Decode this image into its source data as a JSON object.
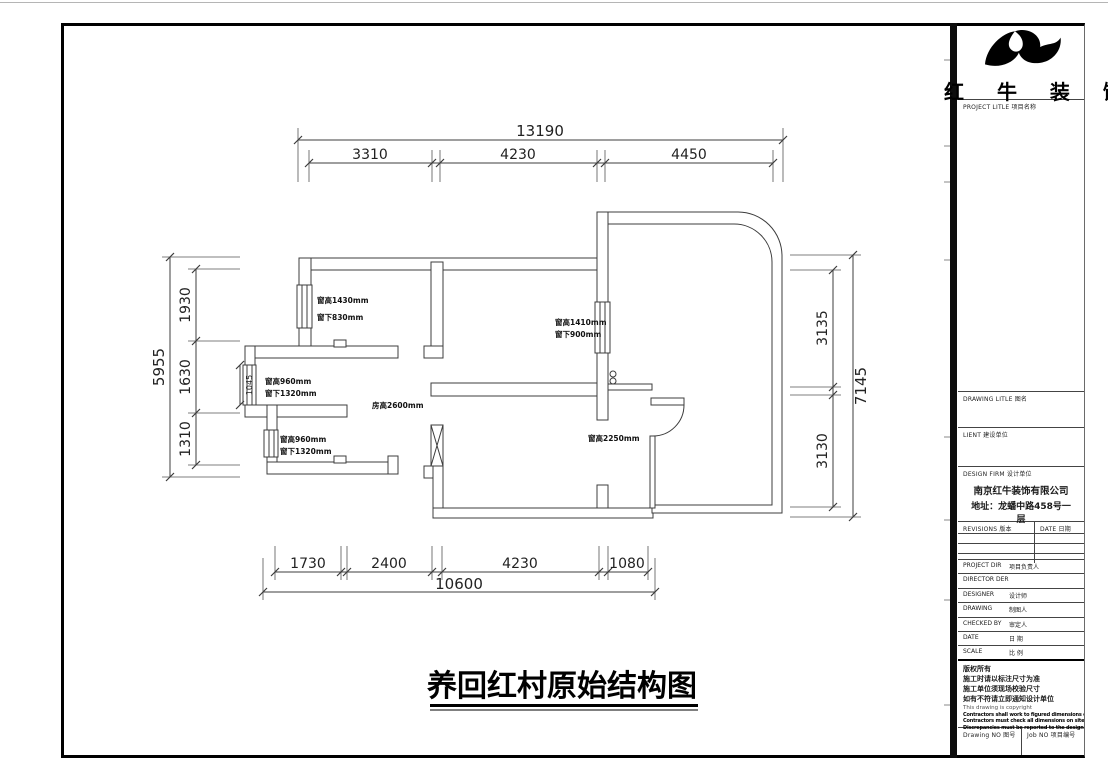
{
  "colors": {
    "line": "#3c3c3c",
    "wall": "#2f2f2f",
    "text": "#1a1a1a",
    "frame": "#000000"
  },
  "logo": {
    "company_name": "红 牛 装 饰"
  },
  "title_block": {
    "project_title_label": "PROJECT LITLE  项目名称",
    "drawing_title_label": "DRAWING LITLE  图名",
    "client_label": "LIENT  建设单位",
    "design_firm_label": "DESIGN FIRM  设计单位",
    "firm_name": "南京红牛装饰有限公司",
    "firm_address_line1": "地址：龙蟠中路458号一",
    "firm_address_line2": "层",
    "revisions_label": "REVISIONS  版本",
    "date_col_label": "DATE  日期",
    "rows": [
      {
        "en": "PROJECT DIR",
        "zh": "项目负责人"
      },
      {
        "en": "DIRECTOR DER",
        "zh": ""
      },
      {
        "en": "DESIGNER",
        "zh": "设计师"
      },
      {
        "en": "DRAWING",
        "zh": "制图人"
      },
      {
        "en": "CHECKED BY",
        "zh": "审定人"
      },
      {
        "en": "DATE",
        "zh": "日 期"
      },
      {
        "en": "SCALE",
        "zh": "比 例"
      }
    ],
    "copyright": {
      "line1": "版权所有",
      "line2": "施工时请以标注尺寸为准",
      "line3": "施工单位须现场校验尺寸",
      "line4": "如有不符请立即通知设计单位",
      "line5": "This drawing is copyright",
      "line6": "Contractors shall work to figured dimensions only",
      "line7": "Contractors must check all dimensions on site",
      "line8": "Discrepancies must be reported to the designer"
    },
    "drawing_no_label": "Drawing NO  图号",
    "job_no_label": "Job NO  项目编号"
  },
  "drawing": {
    "title": "养回红村原始结构图",
    "dims": {
      "top": {
        "overall": "13190",
        "s1": "3310",
        "s2": "4230",
        "s3": "4450"
      },
      "left": {
        "overall": "5955",
        "s1": "1930",
        "s2": "1630",
        "s3": "1310"
      },
      "right": {
        "overall": "7145",
        "s1": "3135",
        "s2": "3130"
      },
      "bottom": {
        "overall": "10600",
        "s1": "1730",
        "s2": "2400",
        "s3": "4230",
        "s4": "1080"
      },
      "bay": "1045"
    },
    "ann": {
      "w1a": "窗高1430mm",
      "w1b": "窗下830mm",
      "w2a": "窗高1410mm",
      "w2b": "窗下900mm",
      "w3a": "窗高960mm",
      "w3b": "窗下1320mm",
      "w4a": "窗高960mm",
      "w4b": "窗下1320mm",
      "room": "房高2600mm",
      "w5": "窗高2250mm"
    }
  }
}
